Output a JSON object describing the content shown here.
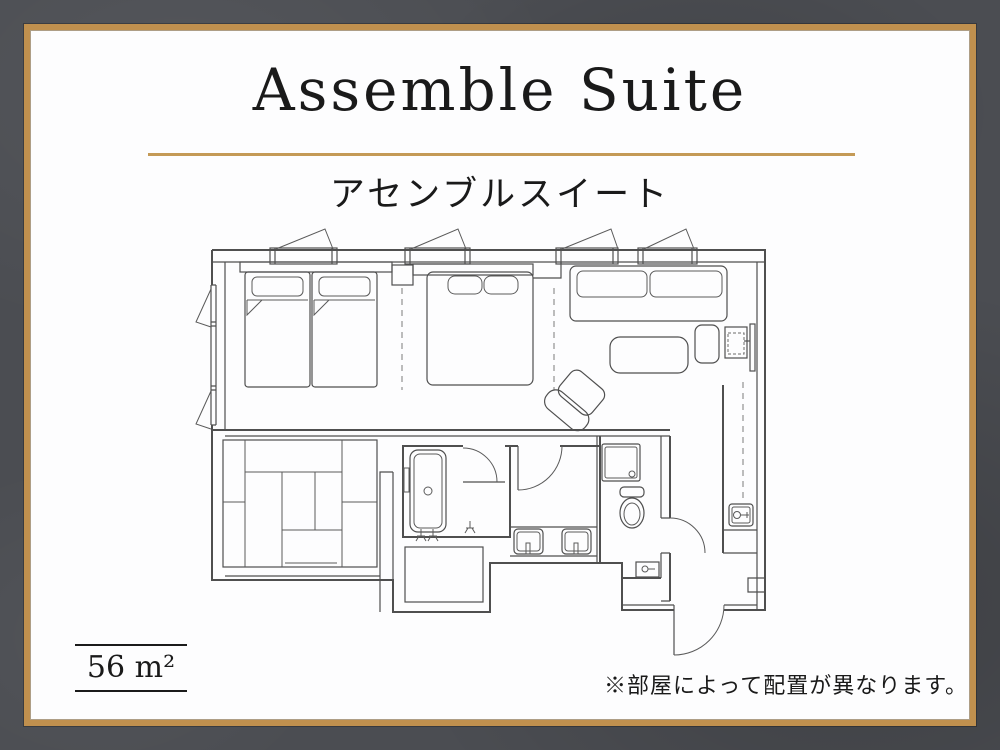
{
  "header": {
    "title": "Assemble Suite",
    "subtitle": "アセンブルスイート"
  },
  "footer": {
    "area": "56 m²",
    "note": "※部屋によって配置が異なります。"
  },
  "colors": {
    "page_bg": "#4b4d52",
    "card_bg": "#fdfdfe",
    "frame_gold": "#c0904e",
    "divider_gold": "#c49a56",
    "ink": "#1a1a1a",
    "plan_line": "#4f4f4f"
  }
}
